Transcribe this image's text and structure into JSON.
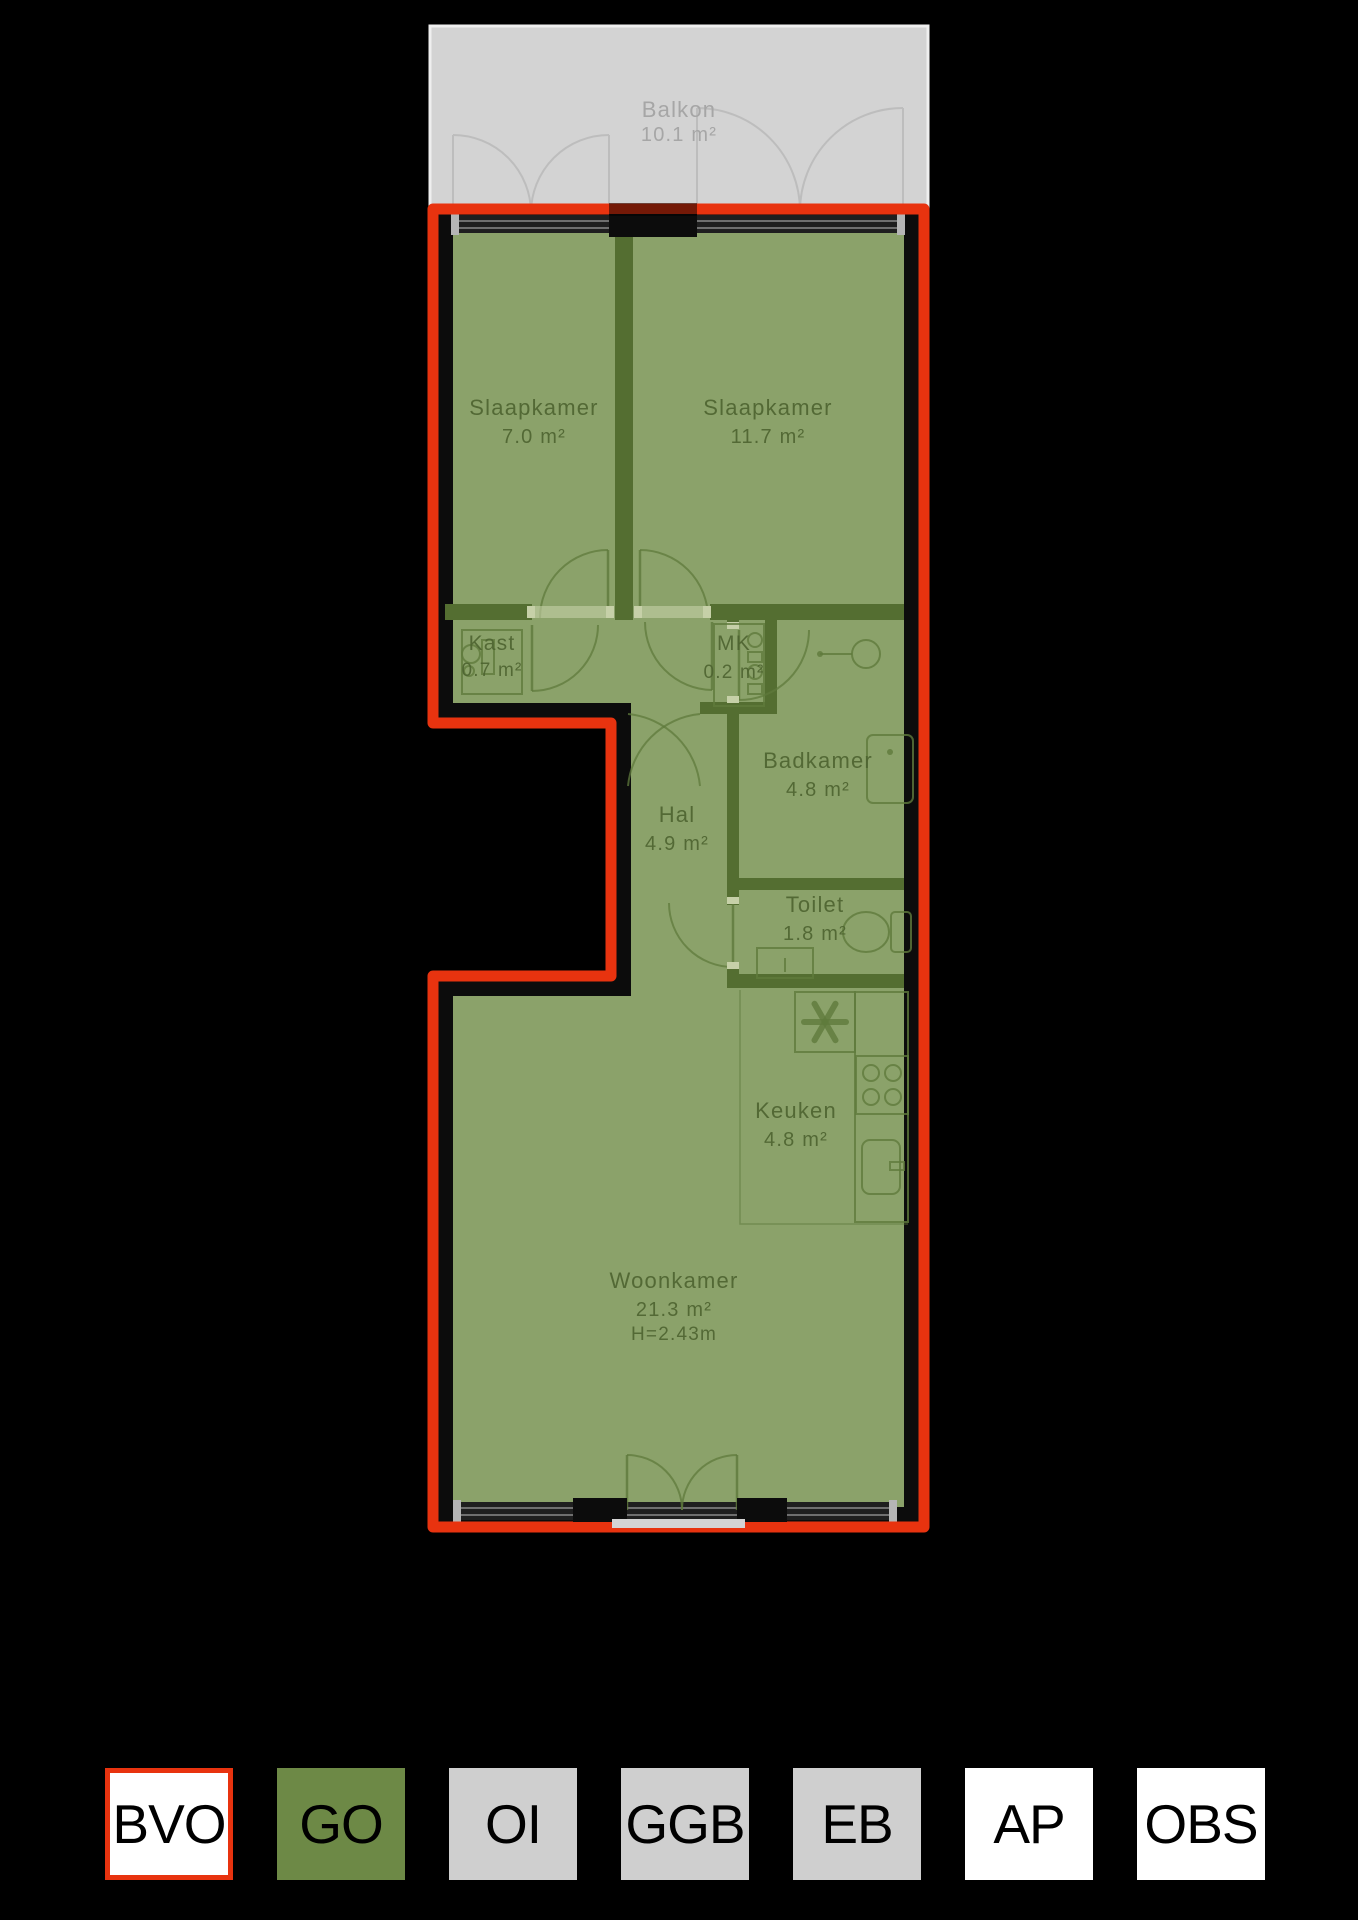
{
  "plan": {
    "balcony": {
      "name": "Balkon",
      "area": "10.1 m²"
    },
    "rooms": [
      {
        "id": "slaapkamer-1",
        "name": "Slaapkamer",
        "area": "7.0 m²"
      },
      {
        "id": "slaapkamer-2",
        "name": "Slaapkamer",
        "area": "11.7 m²"
      },
      {
        "id": "kast",
        "name": "Kast",
        "area": "0.7 m²"
      },
      {
        "id": "mk",
        "name": "MK",
        "area": "0.2 m²"
      },
      {
        "id": "badkamer",
        "name": "Badkamer",
        "area": "4.8 m²"
      },
      {
        "id": "hal",
        "name": "Hal",
        "area": "4.9 m²"
      },
      {
        "id": "toilet",
        "name": "Toilet",
        "area": "1.8 m²"
      },
      {
        "id": "keuken",
        "name": "Keuken",
        "area": "4.8 m²"
      },
      {
        "id": "woonkamer",
        "name": "Woonkamer",
        "area": "21.3 m²",
        "ceiling_height": "H=2.43m"
      }
    ]
  },
  "legend": {
    "items": [
      {
        "label": "BVO",
        "type": "bvo"
      },
      {
        "label": "GO",
        "type": "go"
      },
      {
        "label": "OI",
        "type": "gray"
      },
      {
        "label": "GGB",
        "type": "gray"
      },
      {
        "label": "EB",
        "type": "gray"
      },
      {
        "label": "AP",
        "type": "white"
      },
      {
        "label": "OBS",
        "type": "white"
      }
    ]
  },
  "colors": {
    "bvo_red": "#e8330f",
    "go_green": "#6d8946",
    "room_green": "#8ba26a",
    "wall_olive": "#546e31",
    "line_olive": "#5f7a3c",
    "label_olive": "#4d6330",
    "wall_black": "#0c0c0c",
    "balcony_gray": "#d3d3d3",
    "balcony_edge": "#efefef",
    "balcony_line": "#bdbdbd",
    "balcony_label": "#a6a6a6",
    "legend_gray": "#cfcfcf",
    "window_dark": "#1f1f1f",
    "window_line": "#6f6f6f",
    "window_post": "#b5b5b5",
    "jamb_light": "#c6d0a8",
    "sill_gray": "#d4d4d4"
  }
}
